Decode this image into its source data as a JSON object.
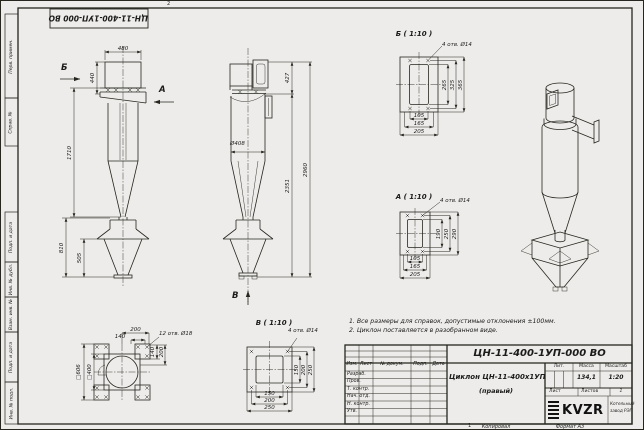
{
  "colors": {
    "paper": "#edecea",
    "ink": "#26261f"
  },
  "frame": {
    "top_stamp": "ЦН-11-400-1УП-000 ВО",
    "left_labels": [
      "Перв. примен.",
      "Справ. №",
      "Подп. и дата",
      "Инв. № дубл.",
      "Взам. инв. №",
      "Подп. и дата",
      "Инв. № подл."
    ],
    "fold_mark_top": "2",
    "fold_mark_bottom": "1",
    "copied_label": "Копировал",
    "format_label": "Формат А3"
  },
  "notes": {
    "line1": "1. Все размеры для справок, допустимые отклонения ±100мм.",
    "line2": "2. Циклон поставляется в разобранном виде."
  },
  "views": {
    "front": {
      "dim_width": "480",
      "dim_inlet_height": "440",
      "dim_body_height": "1710",
      "dim_hopper_height": "810",
      "dim_cone_height": "505",
      "arrow_b": "Б",
      "arrow_a": "А"
    },
    "side": {
      "dim_outlet": "427",
      "dim_diameter": "Ø408",
      "dim_lower": "2351",
      "dim_total": "2960",
      "arrow_v": "В"
    },
    "detail_b": {
      "title": "Б ( 1:10 )",
      "holes_note": "4 отв. Ø14",
      "v_dims": [
        "265",
        "325",
        "365"
      ],
      "h_dims": [
        "105",
        "165",
        "205"
      ]
    },
    "detail_a": {
      "title": "А ( 1:10 )",
      "holes_note": "4 отв. Ø14",
      "v_dims": [
        "190",
        "250",
        "290"
      ],
      "h_dims": [
        "105",
        "165",
        "205"
      ]
    },
    "detail_v": {
      "title": "В ( 1:10 )",
      "holes_note": "4 отв. Ø14",
      "v_dims": [
        "150",
        "200",
        "250"
      ],
      "h_dims": [
        "150",
        "200",
        "250"
      ]
    },
    "top": {
      "holes_note": "12 отв. Ø18",
      "dim_top_200": "200",
      "dim_top_140": "140",
      "dim_right_140": "140",
      "dim_right_200": "200",
      "dim_square_outer": "□606",
      "dim_square_inner": "□400"
    }
  },
  "title_block": {
    "doc_number": "ЦН-11-400-1УП-000 ВО",
    "product_name": "Циклон ЦН-11-400х1УП",
    "product_variant": "(правый)",
    "col_headers": [
      "Изм.",
      "Лист",
      "№ докум.",
      "Подп.",
      "Дата"
    ],
    "row_labels": [
      "Разраб.",
      "Пров.",
      "Т. контр.",
      "Нач. отд.",
      "Н. контр.",
      "Утв."
    ],
    "lit_label": "Лит.",
    "mass_label": "Масса",
    "scale_label": "Масштаб",
    "mass_value": "134,1",
    "scale_value": "1:20",
    "sheet_label": "Лист",
    "sheets_label": "Листов",
    "sheets_value": "1",
    "logo_text": "KVZR",
    "company_line1": "Котельный",
    "company_line2": "завод РЭП"
  }
}
